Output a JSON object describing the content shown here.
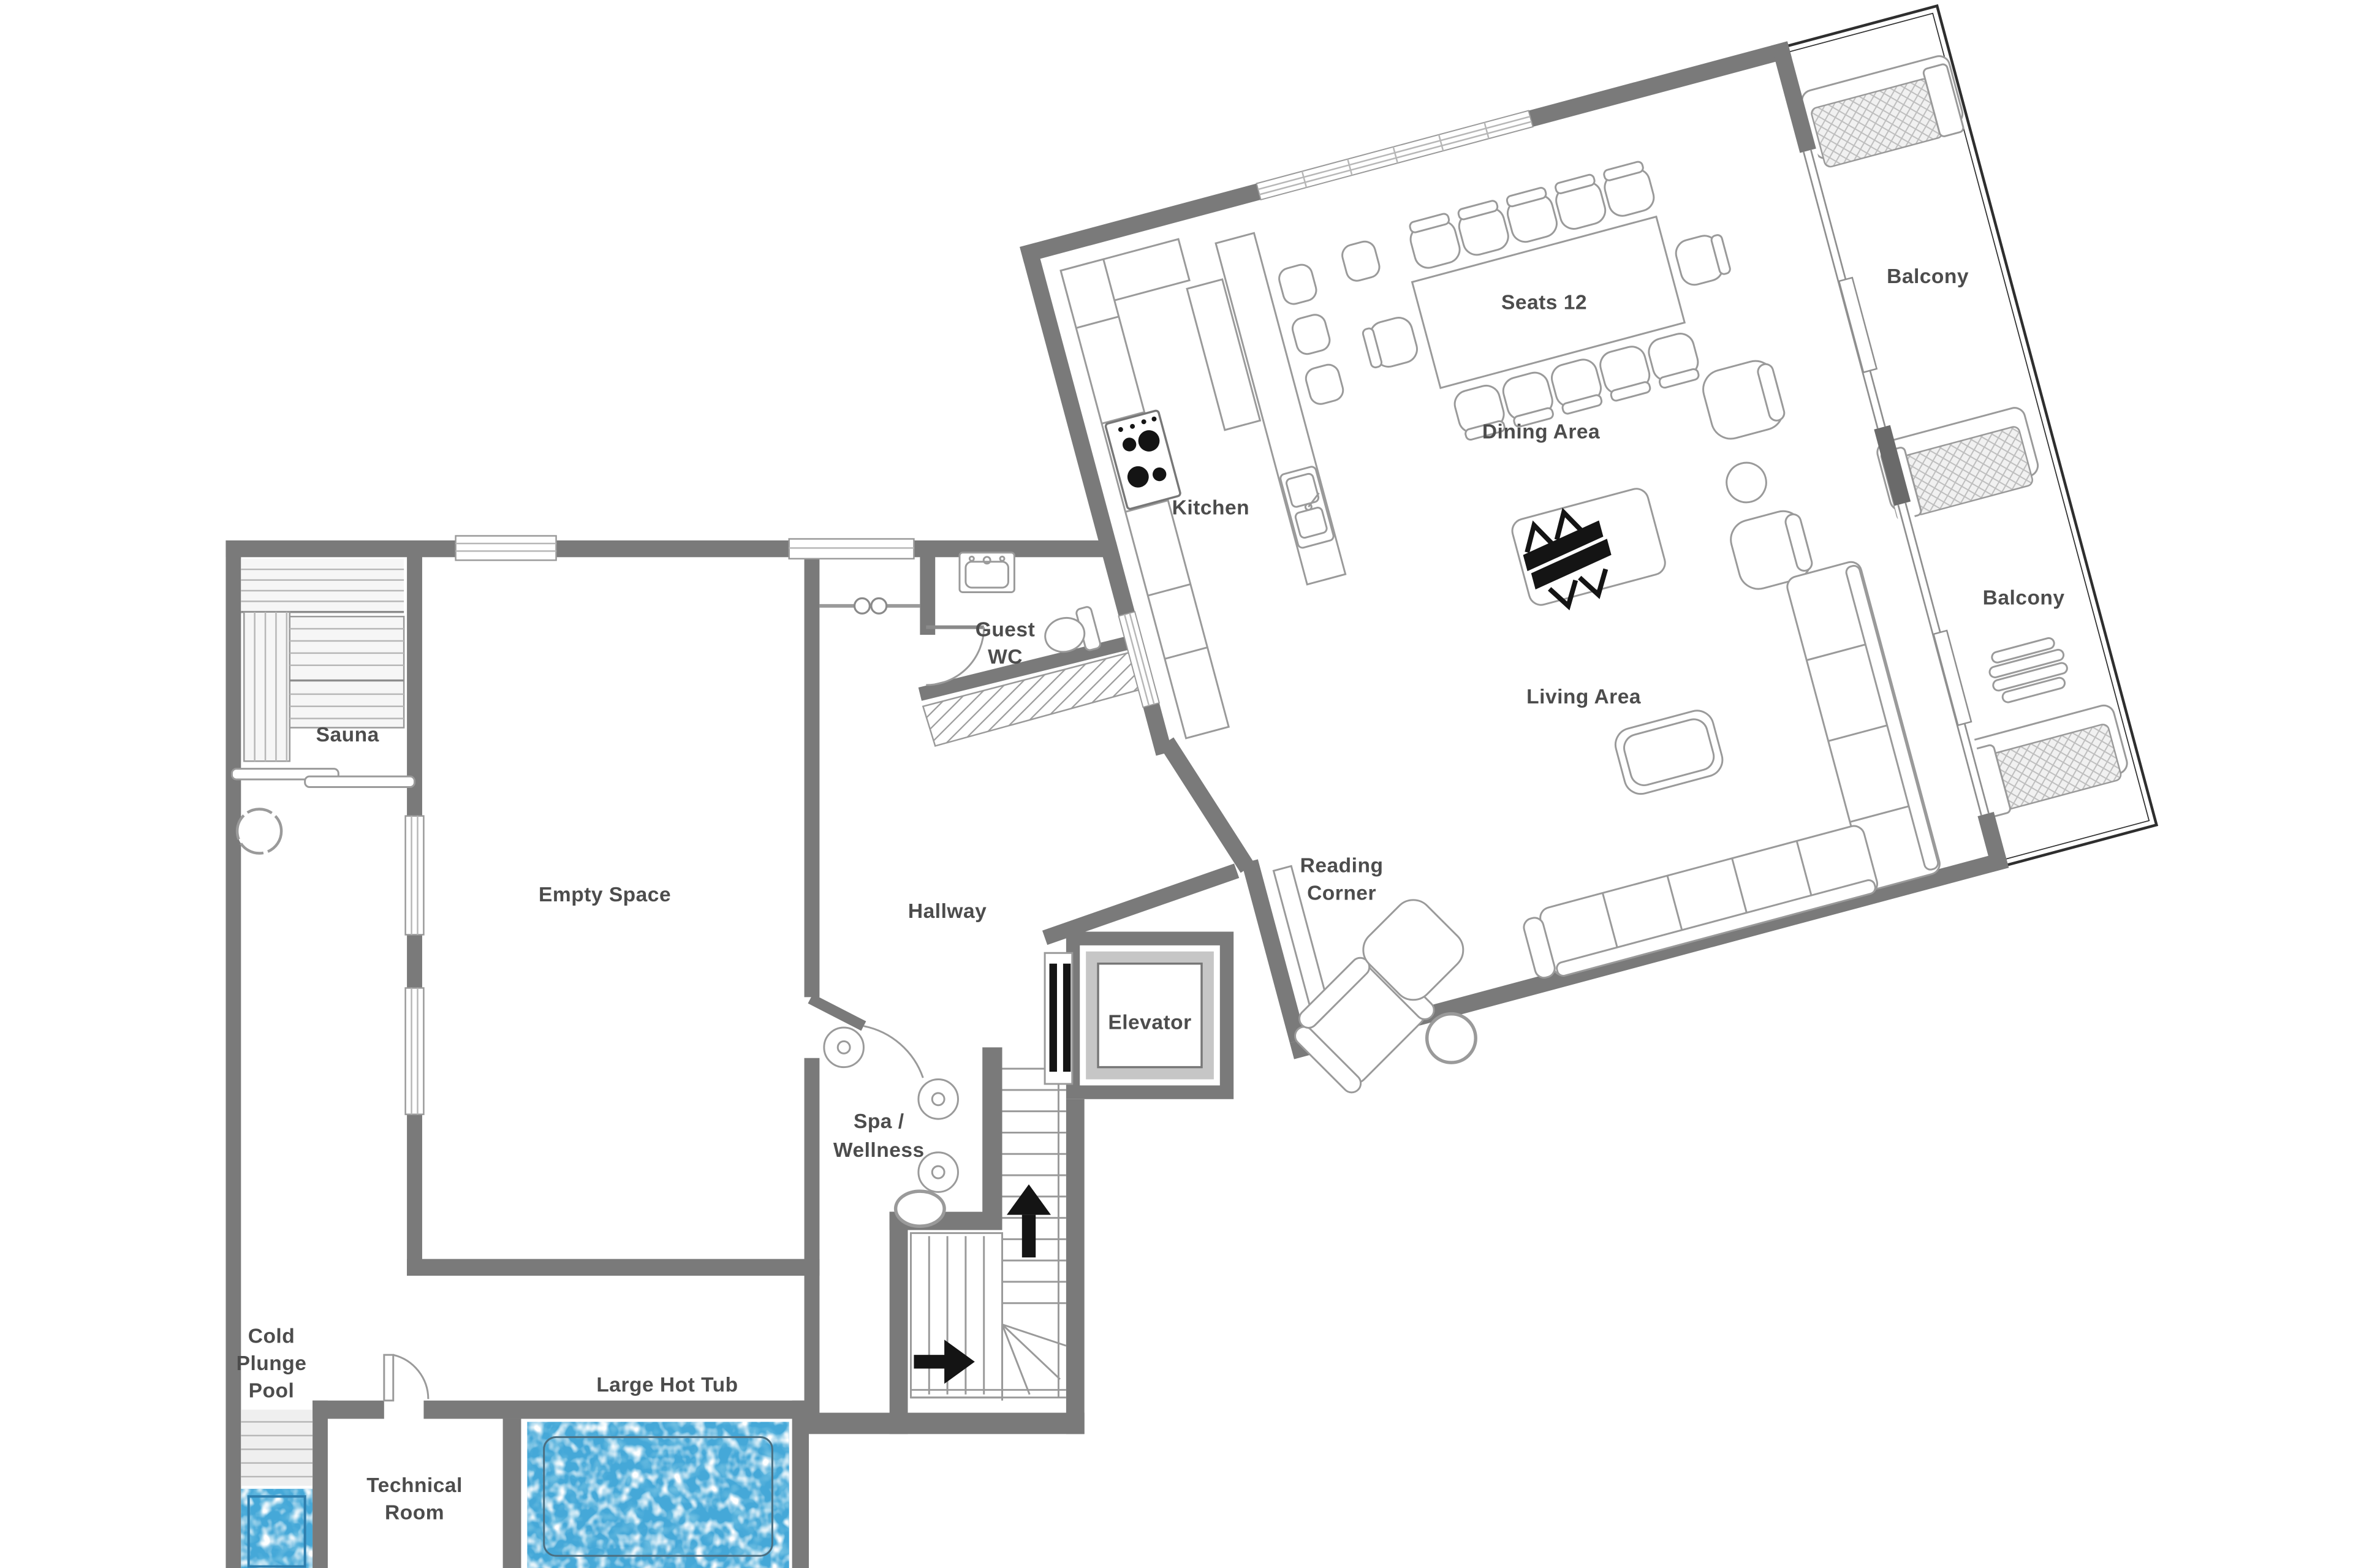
{
  "plan": {
    "type": "floor-plan",
    "rotated_wing_angle_deg": -15,
    "colors": {
      "wall": "#7a7a7a",
      "water": "#45a8d8",
      "water_deep": "#2f8fc4",
      "text": "#4c4c4c",
      "furniture_line": "#9a9a9a"
    }
  },
  "labels": {
    "sauna": "Sauna",
    "empty_space": "Empty Space",
    "hallway": "Hallway",
    "spa_line1": "Spa /",
    "spa_line2": "Wellness",
    "guest_wc_line1": "Guest",
    "guest_wc_line2": "WC",
    "elevator": "Elevator",
    "kitchen": "Kitchen",
    "seats": "Seats 12",
    "dining": "Dining Area",
    "living": "Living Area",
    "reading_line1": "Reading",
    "reading_line2": "Corner",
    "balcony_upper": "Balcony",
    "balcony_lower": "Balcony",
    "cold_line1": "Cold",
    "cold_line2": "Plunge",
    "cold_line3": "Pool",
    "technical_line1": "Technical",
    "technical_line2": "Room",
    "hot_tub": "Large Hot Tub"
  }
}
